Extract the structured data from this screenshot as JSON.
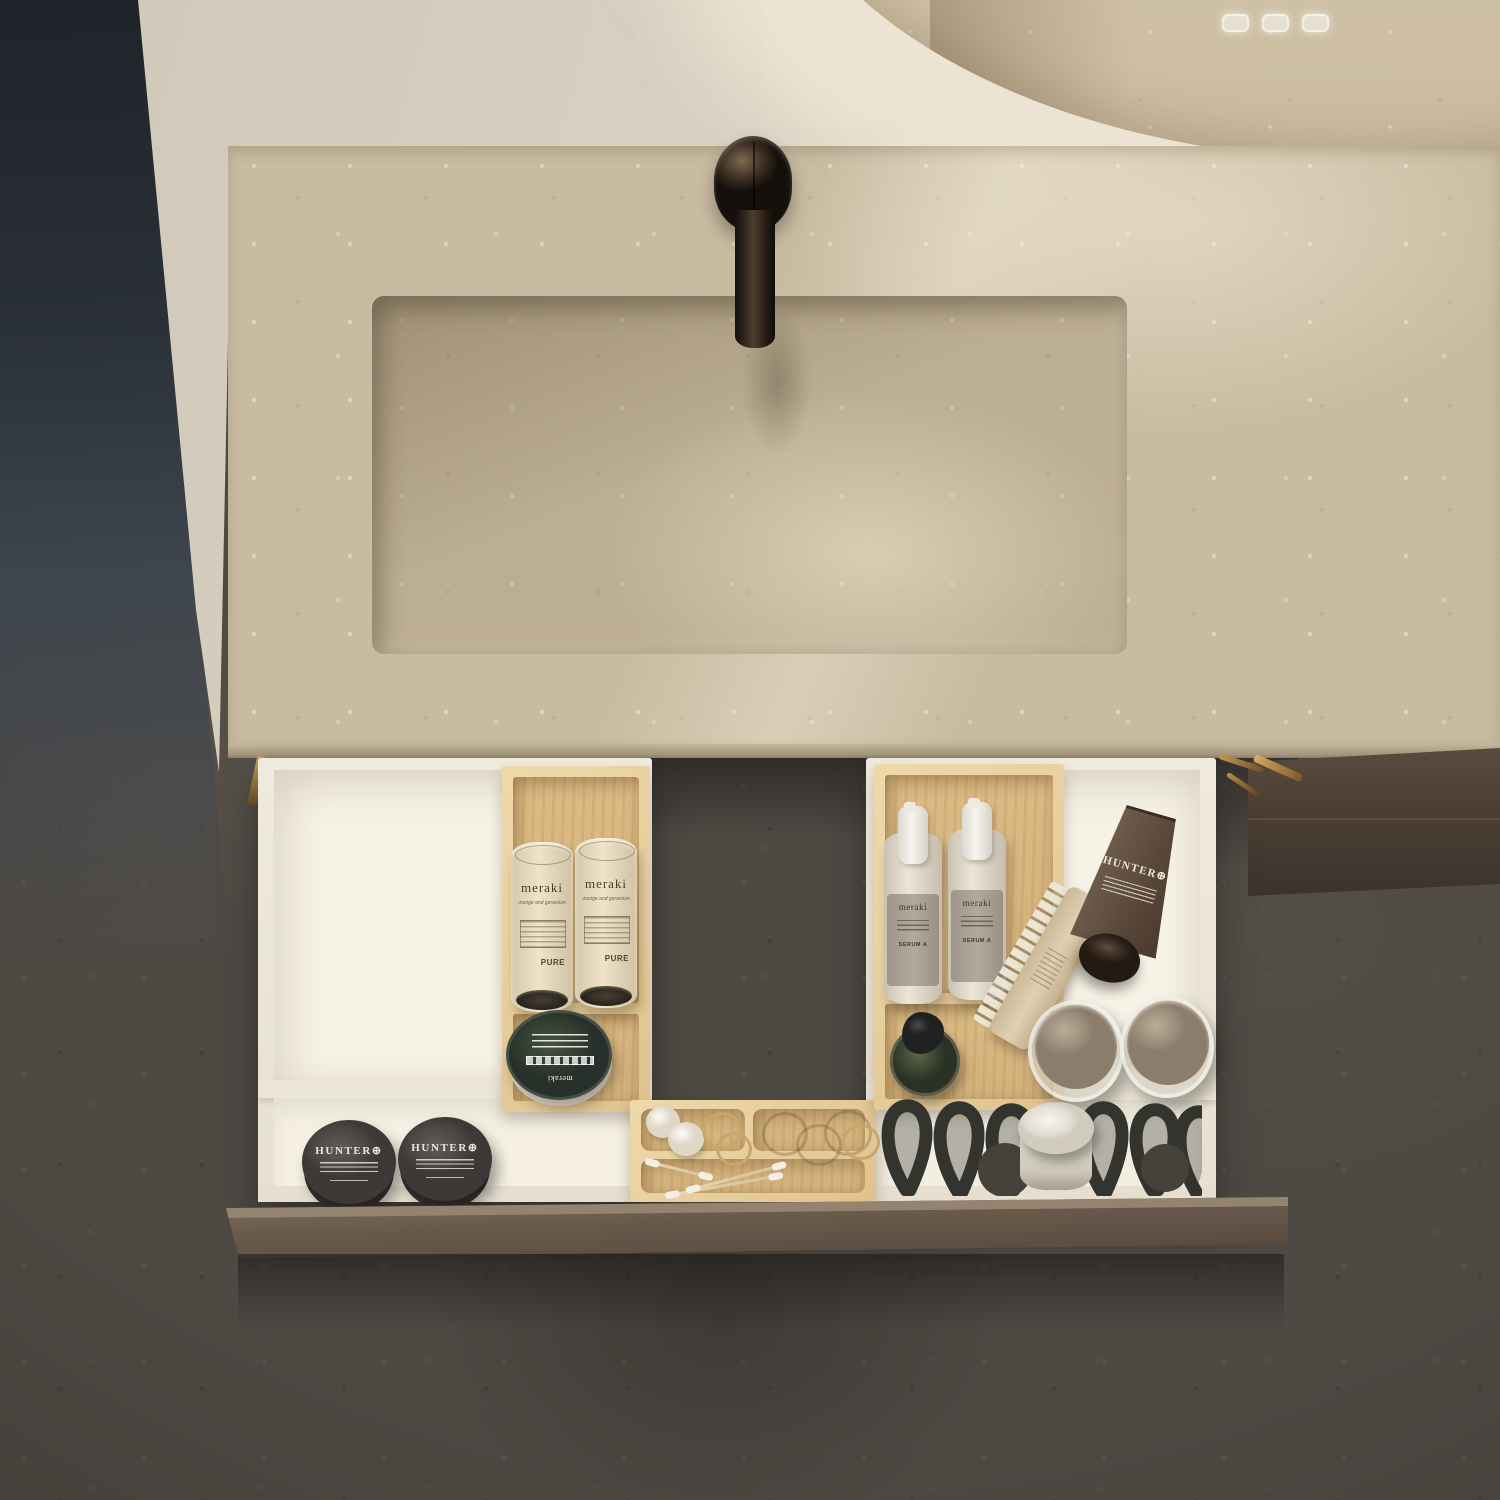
{
  "scene": {
    "title": "Top-down render of a bathroom vanity: beige marble countertop with integrated sink and bronze faucet, LED mirror above, and an open drawer with white and bamboo organizers holding toiletries"
  },
  "labels": {
    "meraki_tube": {
      "brand": "meraki",
      "subtitle": "orange and geranium",
      "footer": "PURE"
    },
    "meraki_serum": {
      "brand": "meraki",
      "type": "SERUM A"
    },
    "meraki_tin": {
      "brand": "meraki"
    },
    "hunter_jar": {
      "brand": "HUNTER",
      "symbol": "⊕"
    },
    "hunter_tube": {
      "brand": "HUNTER",
      "symbol": "⊕"
    }
  },
  "counts": {
    "meraki_tubes": 2,
    "serum_bottles": 2,
    "hunter_jars": 2,
    "glass_jars": 2,
    "cotton_balls": 2,
    "cotton_swabs": 3,
    "towel_loops": 6,
    "mirror_touch_controls": 3
  },
  "colors": {
    "floor_stone": "#4e4943",
    "dark_wall": "#262b31",
    "cream_wall": "#dbd3c4",
    "marble": "#c8bba1",
    "faucet_bronze": "#2b211a",
    "drawer_front": "#6a5b4c",
    "drawer_box_white": "#f2ecdf",
    "bamboo_wood": "#dcbc8b",
    "brass_rail": "#c29a55",
    "meraki_tin_green": "#37422f",
    "hunter_gray": "#56504d",
    "hunter_brown": "#5c4a3b",
    "serum_label_gray": "#a79d91",
    "towel_loop_dark": "#3b3b38"
  }
}
